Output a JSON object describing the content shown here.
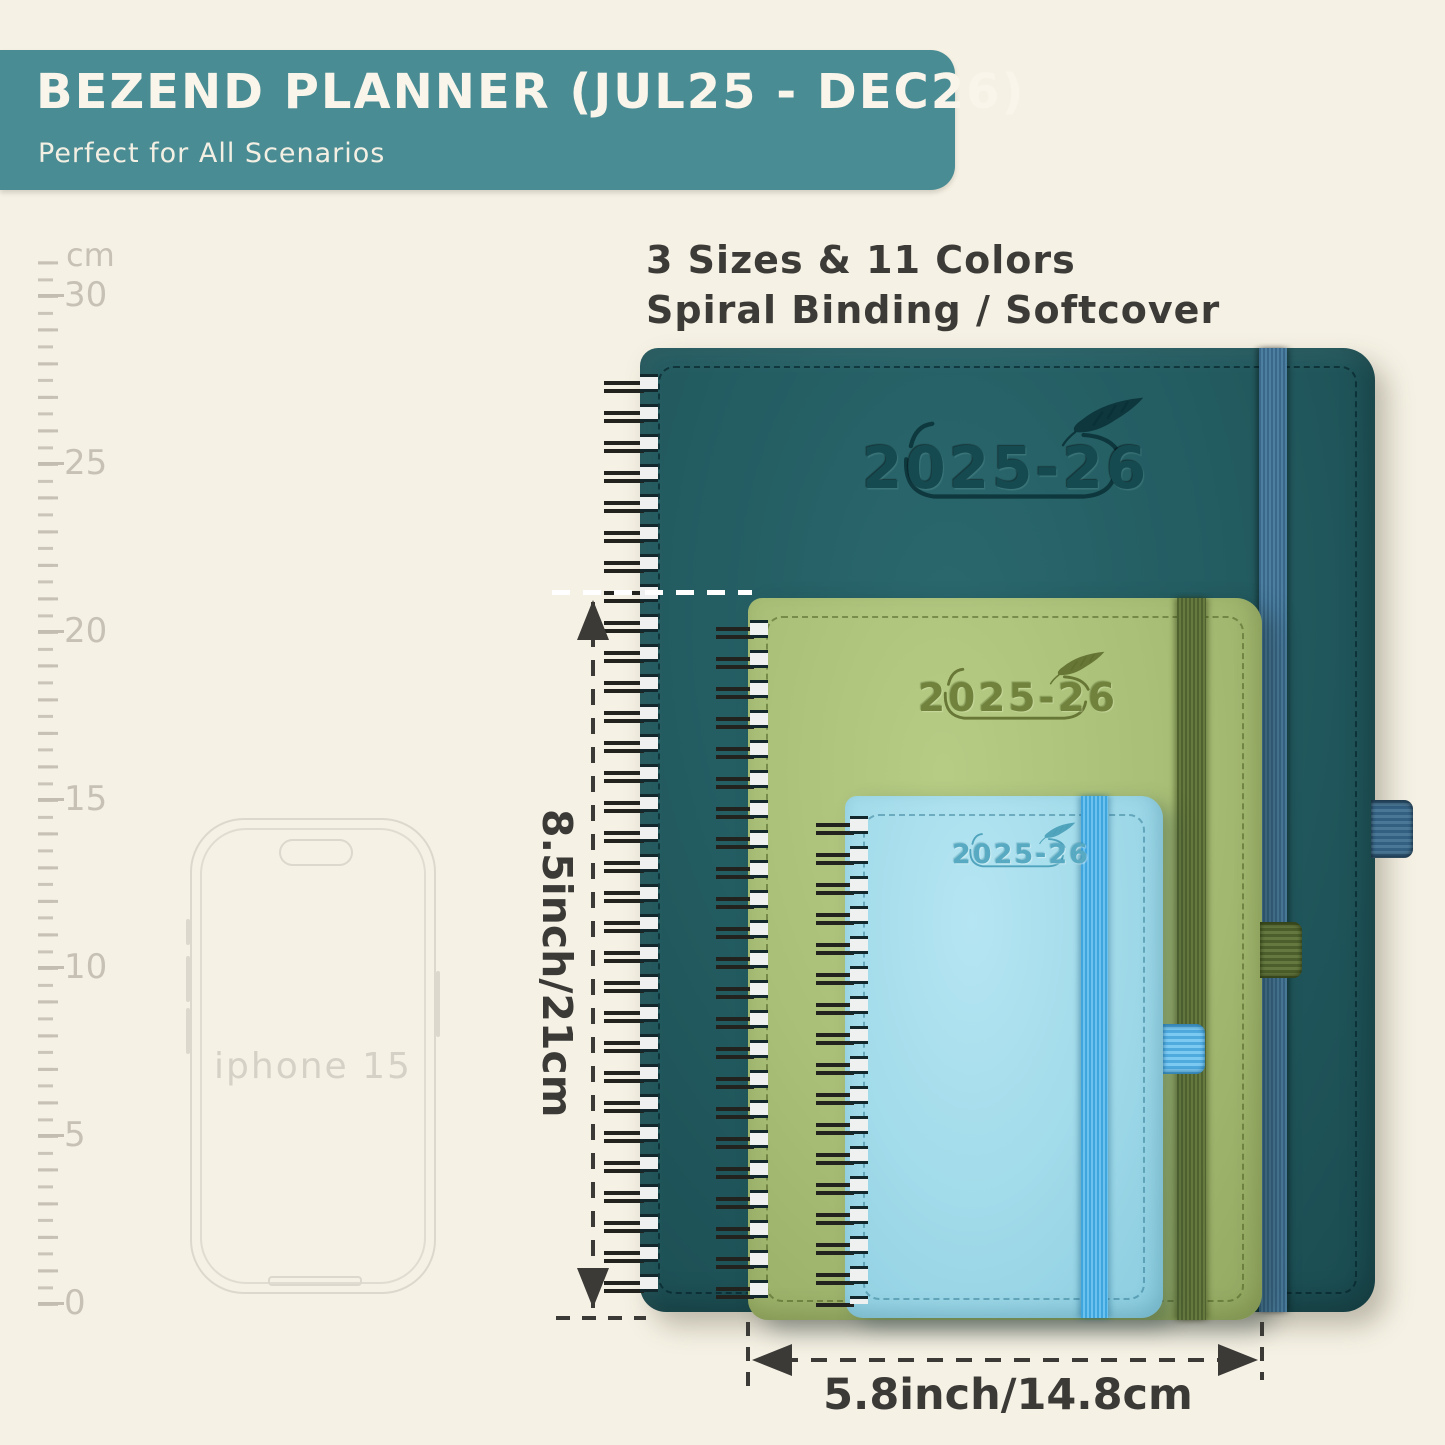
{
  "banner": {
    "title": "BEZEND PLANNER (JUL25 - DEC26)",
    "subtitle": "Perfect for All Scenarios",
    "bg_color": "#4a8c94",
    "text_color": "#f9f5ea"
  },
  "info": {
    "line1": "3 Sizes & 11 Colors",
    "line2": "Spiral Binding / Softcover"
  },
  "ruler": {
    "unit": "cm",
    "labels": [
      "30",
      "25",
      "20",
      "15",
      "10",
      "5",
      "0"
    ]
  },
  "phone": {
    "label": "iphone 15"
  },
  "planners": {
    "large": {
      "year": "2025-26",
      "cover_color": "#235c61",
      "band_color": "#44759a"
    },
    "medium": {
      "year": "2025-26",
      "cover_color": "#a9bf77",
      "band_color": "#5c6f3a"
    },
    "small": {
      "year": "2025-26",
      "cover_color": "#a2dbea",
      "band_color": "#55b6e8"
    }
  },
  "dimensions": {
    "height_label": "8.5inch/21cm",
    "width_label": "5.8inch/14.8cm"
  },
  "icons": {
    "feather": "feather-quill-icon"
  },
  "colors": {
    "background": "#f5f1e4",
    "annotation": "#3b3a37",
    "ruler": "#c6c1b4"
  }
}
